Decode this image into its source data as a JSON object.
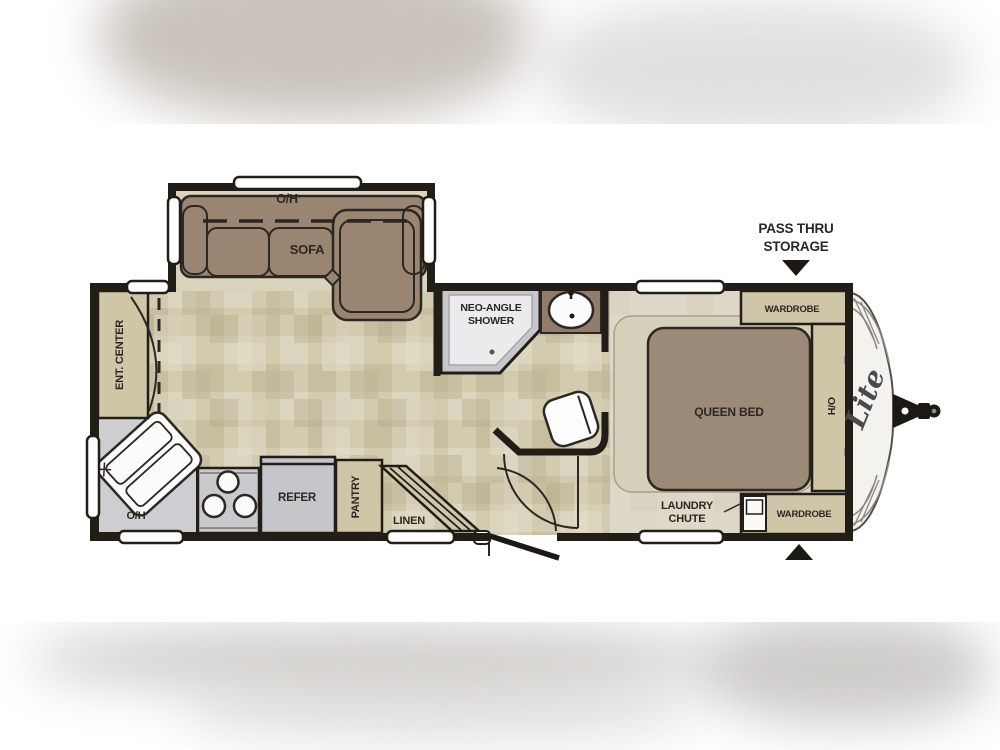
{
  "image": {
    "type": "travel-trailer floor plan"
  },
  "floorplan": {
    "labels": {
      "slide_overhead": "O/H",
      "sofa": "SOFA",
      "ent_center": "ENT. CENTER",
      "kitchen_overhead": "O/H",
      "refer": "REFER",
      "pantry": "PANTRY",
      "linen": "LINEN",
      "shower_line1": "NEO-ANGLE",
      "shower_line2": "SHOWER",
      "queen_bed": "QUEEN BED",
      "wardrobe_top": "WARDROBE",
      "bed_overhead": "O/H",
      "wardrobe_bottom": "WARDROBE",
      "laundry_line1": "LAUNDRY",
      "laundry_line2": "CHUTE",
      "pass_thru_line1": "PASS THRU",
      "pass_thru_line2": "STORAGE",
      "brand_logo": "Lite"
    },
    "colors": {
      "wall": "#231d18",
      "furniture_brown": "#9a8573",
      "vanity_brown": "#8f7c6b",
      "cabinet_tan": "#cfc6a8",
      "counter_gray": "#cdced2",
      "floor_tan": "#d3cbae",
      "bedroom_floor": "#ded8c8",
      "label_text": "#2c2722"
    }
  }
}
